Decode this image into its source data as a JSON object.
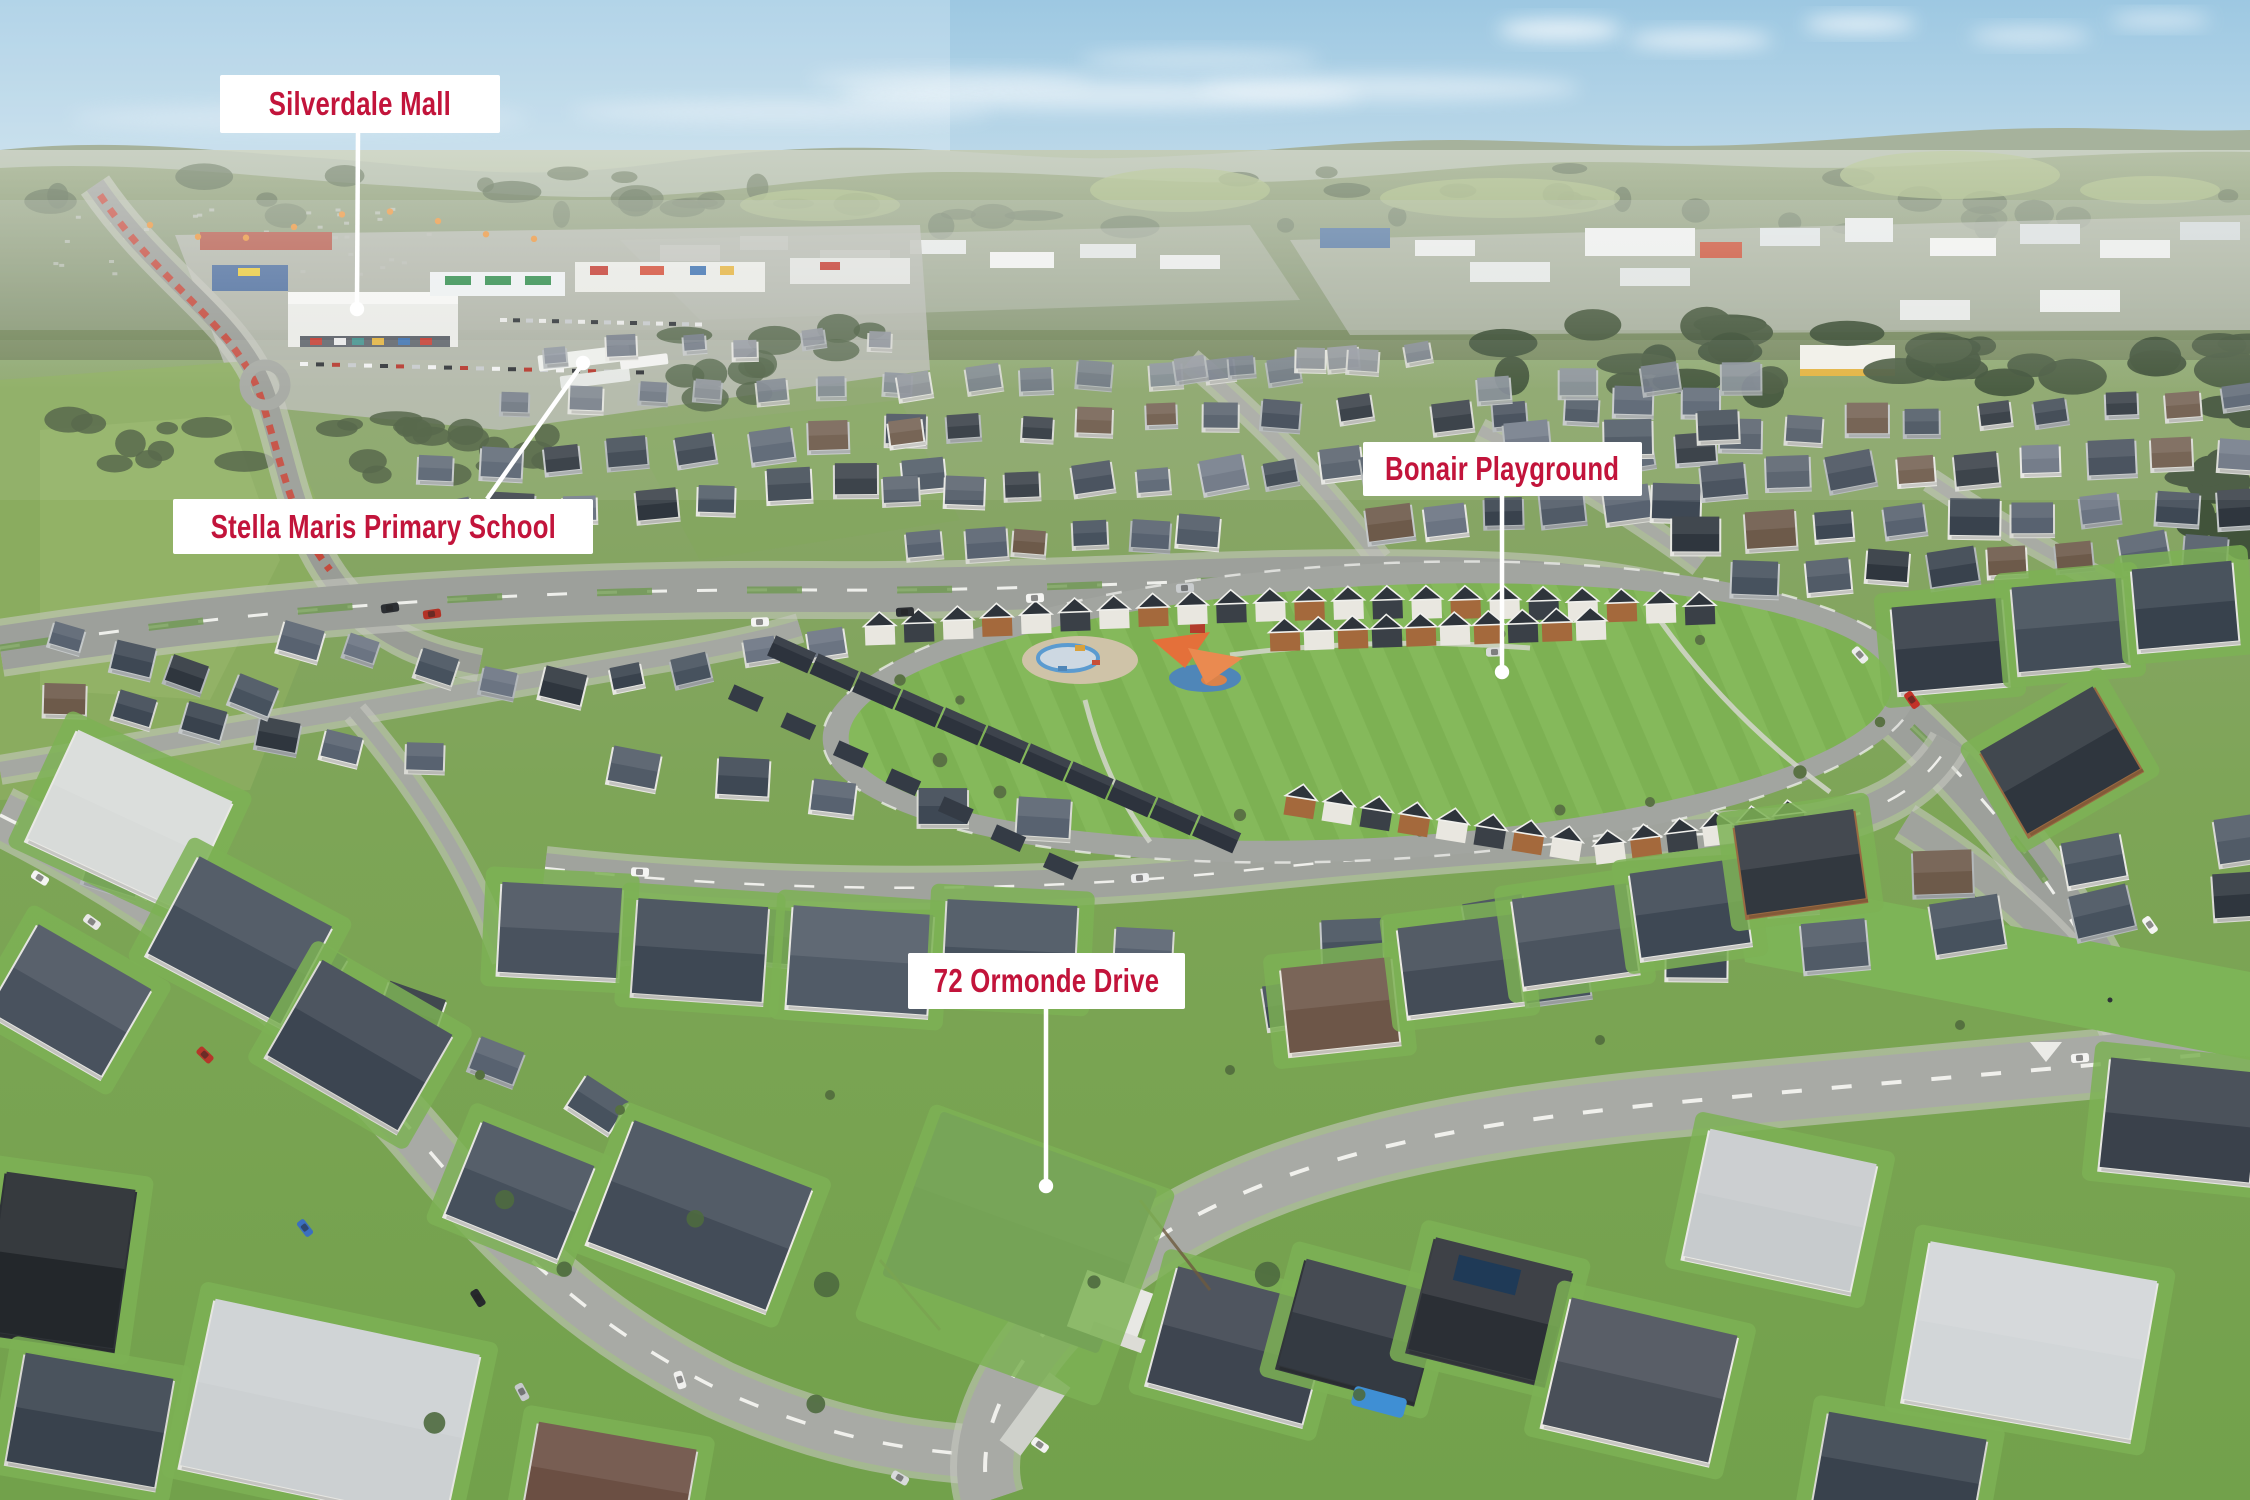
{
  "annotations": {
    "silverdale_mall": "Silverdale Mall",
    "stella_maris_school": "Stella Maris Primary School",
    "bonair_playground": "Bonair Playground",
    "subject_address": "72 Ormonde Drive"
  },
  "colors": {
    "annotation_text": "#c2143b",
    "annotation_bg": "#ffffff",
    "leader_line": "#ffffff"
  }
}
